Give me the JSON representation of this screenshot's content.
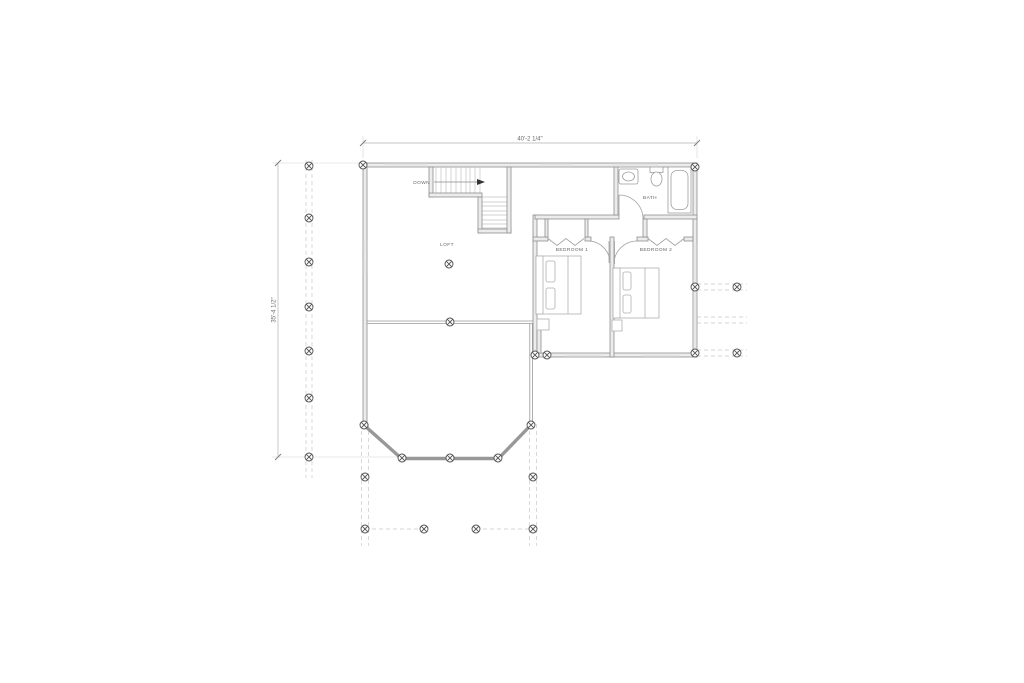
{
  "page": {
    "background": "#ffffff",
    "type": "architectural-floor-plan"
  },
  "plan": {
    "room_labels": {
      "loft": "LOFT",
      "bedroom1": "BEDROOM 1",
      "bedroom2": "BEDROOM 2",
      "bath": "BATH"
    },
    "stair_label": "DOWN",
    "dimensions": {
      "top_width": "40'-2 1/4\"",
      "left_height": "35'-4 1/2\""
    },
    "symbols": {
      "column_marker": "circle-x-column-marker"
    },
    "colors": {
      "wall_line": "#8f8f8f",
      "wall_fill": "#ececec",
      "thin_line": "#a3a3a3",
      "window_line": "#bdbdbd",
      "dashed_line": "#c9c9c9",
      "dimension_line": "#b3b3b3",
      "marker_line": "#4f4f4f",
      "label_text": "#666666"
    }
  }
}
